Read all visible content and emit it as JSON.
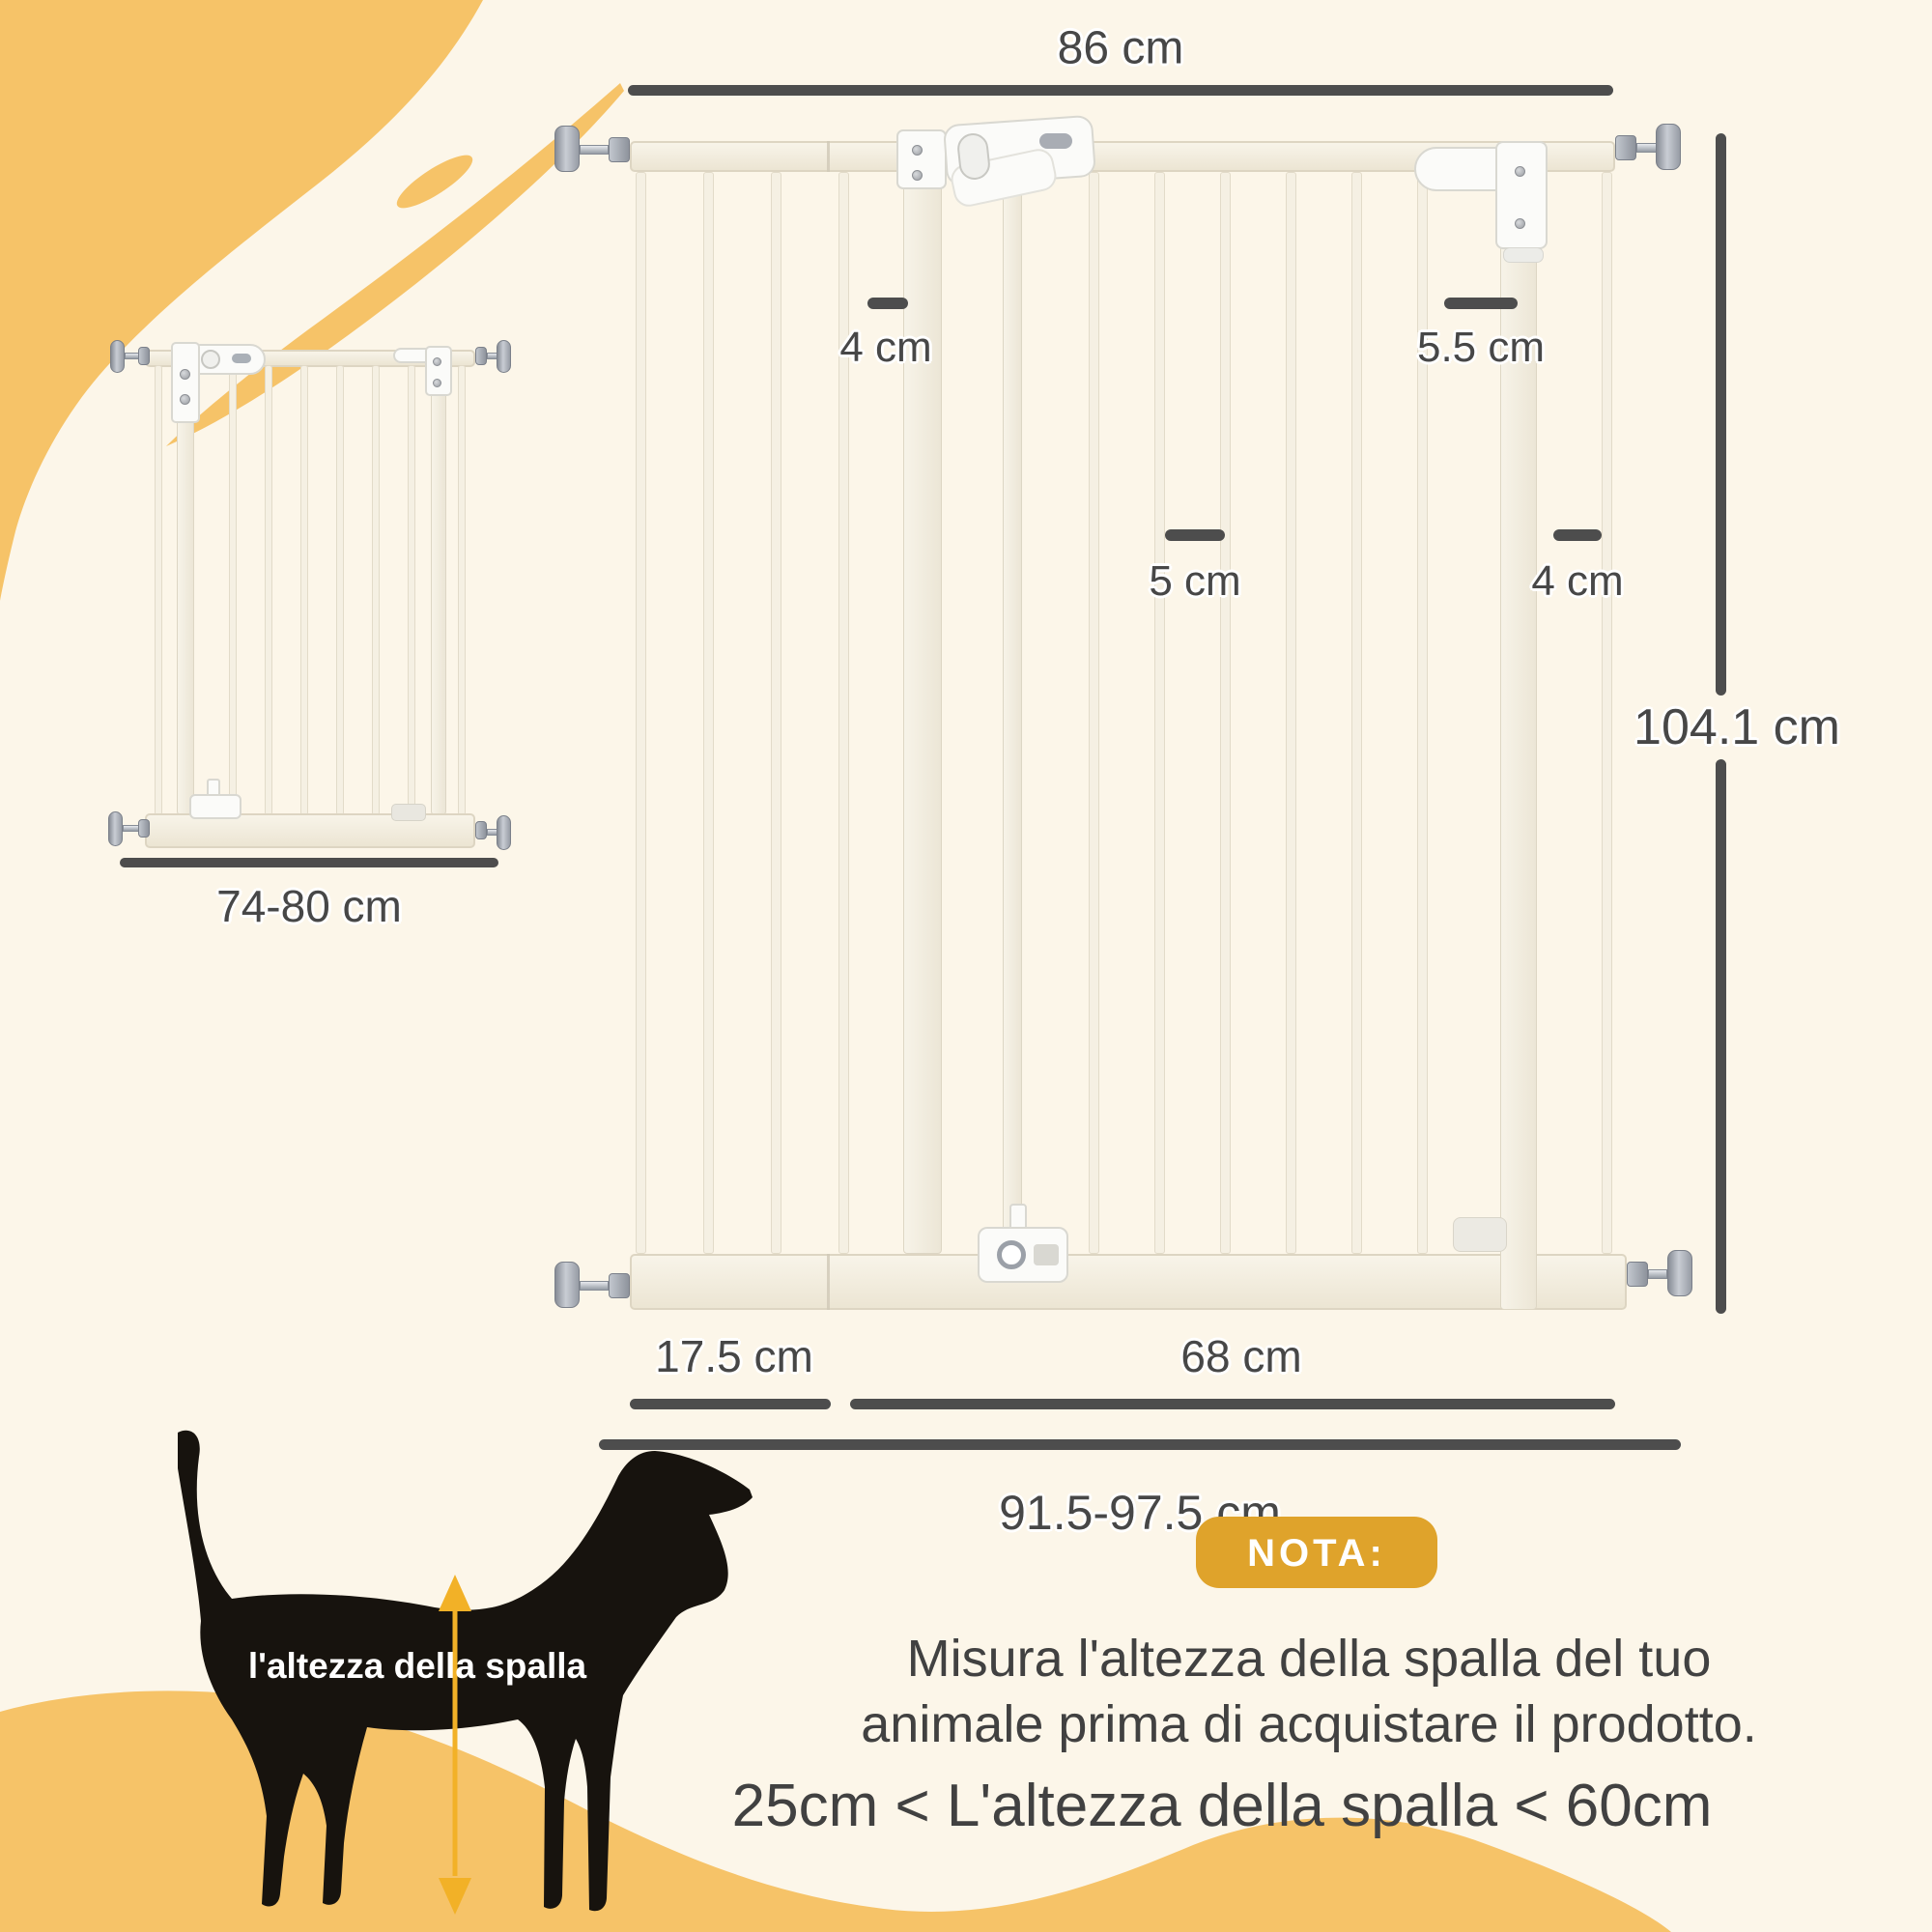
{
  "page": {
    "type": "product-dimension-infographic",
    "language": "it"
  },
  "colors": {
    "background": "#FCF6E9",
    "accent_yellow": "#F6C368",
    "badge_gold": "#DFA32B",
    "dimension_gray": "#4D4D4D",
    "dog_black": "#17130E",
    "arrow_gold": "#F2B127",
    "gate_ivory": "#F4EFE2"
  },
  "large_gate": {
    "width_label": "86 cm",
    "height_label": "104.1 cm",
    "left_bar_gap_label": "4 cm",
    "hinge_gap_label": "5.5 cm",
    "center_bar_gap_label": "5 cm",
    "right_gap_label": "4 cm",
    "extension_label": "17.5 cm",
    "door_label": "68 cm",
    "total_width_label": "91.5-97.5 cm"
  },
  "small_gate": {
    "width_label": "74-80 cm"
  },
  "dog": {
    "shoulder_height_label": "l'altezza della spalla"
  },
  "note": {
    "badge_label": "NOTA:",
    "line1": "Misura l'altezza della spalla del tuo",
    "line2": "animale prima di acquistare il prodotto.",
    "line3": "25cm < L'altezza della spalla < 60cm"
  }
}
